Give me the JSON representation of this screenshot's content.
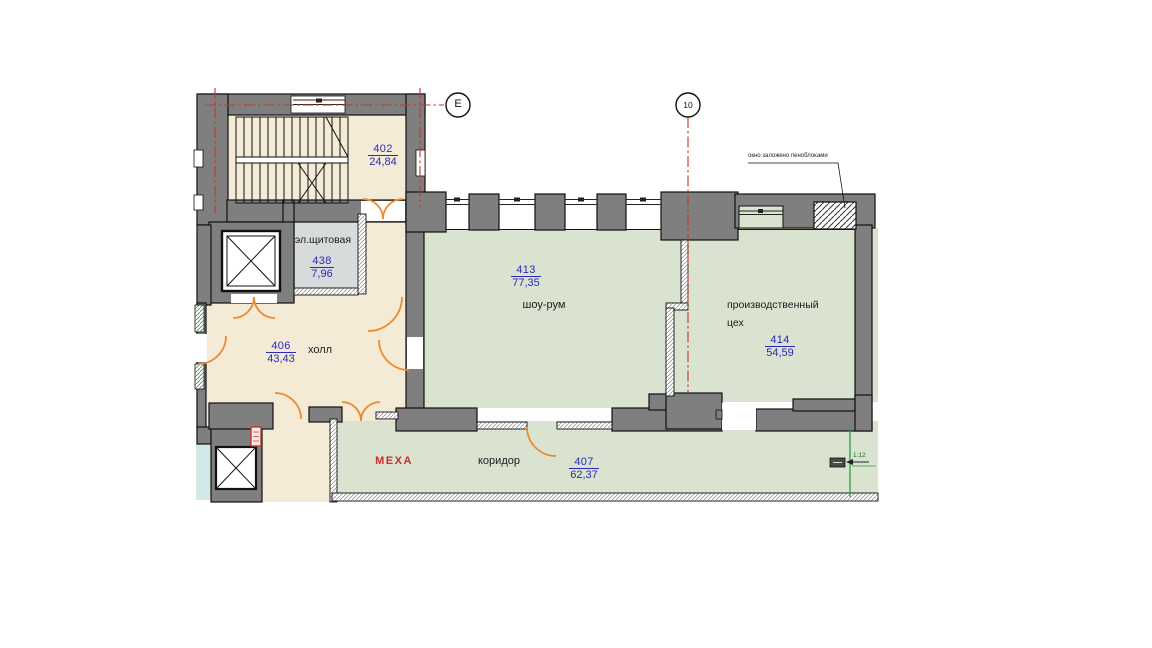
{
  "grid_markers": {
    "horizontal": "E",
    "vertical": "10"
  },
  "rooms": [
    {
      "number": "402",
      "area": "24,84",
      "name": ""
    },
    {
      "number": "438",
      "area": "7,96",
      "name": "эл.щитовая"
    },
    {
      "number": "406",
      "area": "43,43",
      "name": "холл"
    },
    {
      "number": "413",
      "area": "77,35",
      "name": "шоу-рум"
    },
    {
      "number": "414",
      "area": "54,59",
      "name": "производственный цех"
    },
    {
      "number": "407",
      "area": "62,37",
      "name": "коридор"
    }
  ],
  "annotations": {
    "blocked_window": "окно заложено пеноблоками",
    "zone_label": "МЕХА",
    "ramp_slope": "1:12"
  },
  "colors": {
    "wall": "#7f7f7f",
    "beige": "#f4ebd7",
    "green": "#d9e3cf",
    "service_gray": "#d7dbdb",
    "light_blue": "#d2e9e9",
    "door_orange": "#ee8a2e",
    "grid_red": "#c0392b",
    "number_blue": "#2a2ab8",
    "zone_red": "#d42a2a",
    "measure_green": "#2a9d4a"
  }
}
